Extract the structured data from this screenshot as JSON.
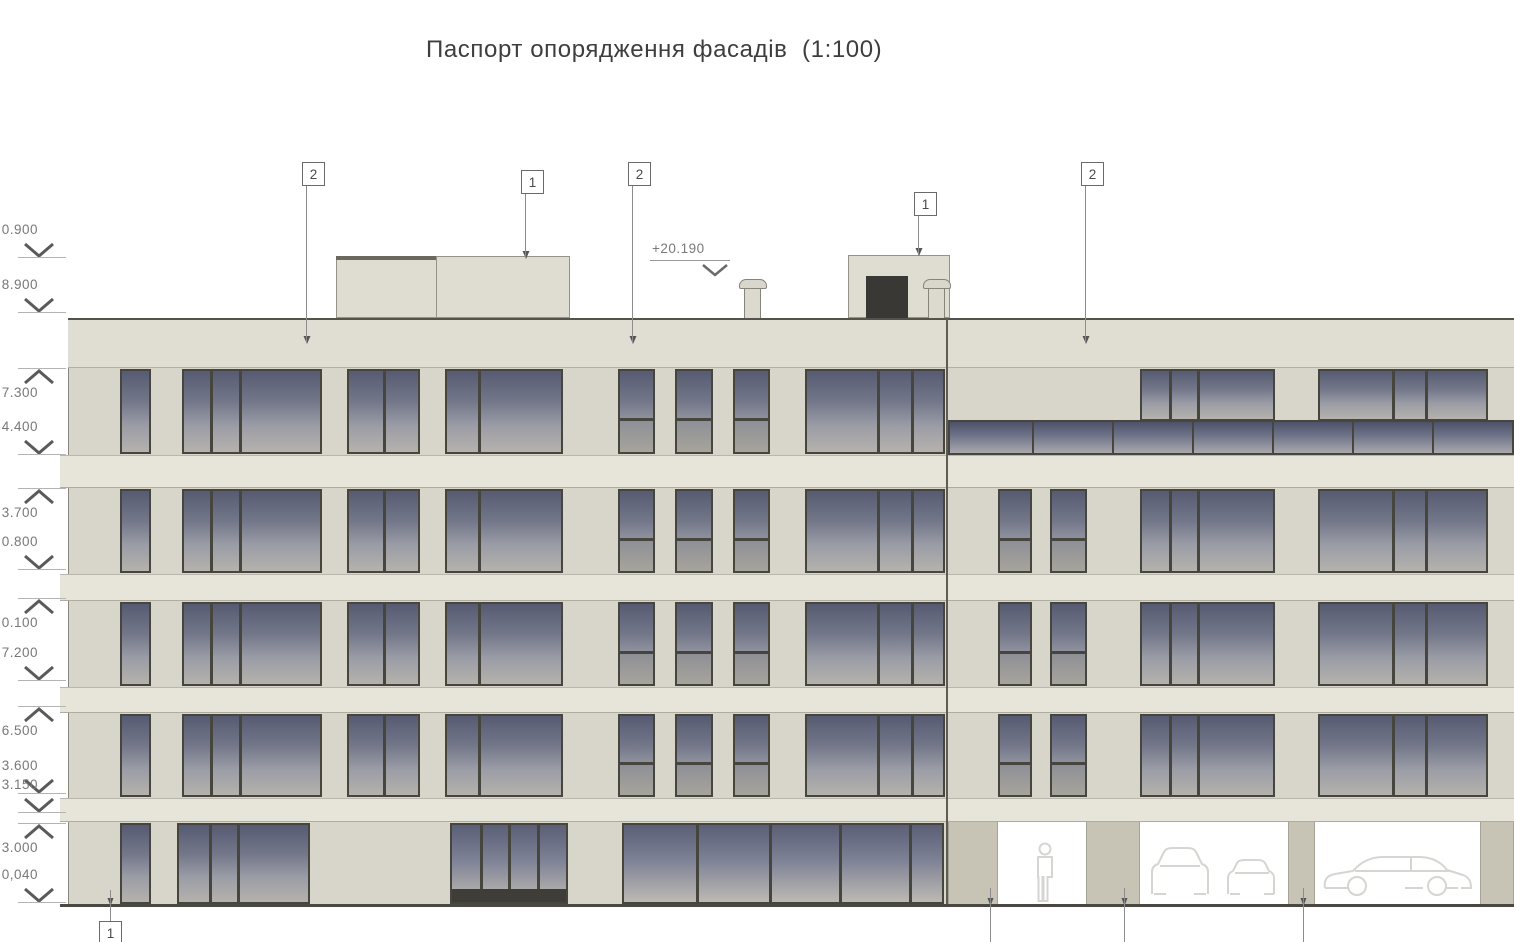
{
  "title": "Паспорт опорядження фасадів  (1:100)",
  "drawing": {
    "roof_annotation": {
      "text": "+20.190",
      "x": 652,
      "y": 241,
      "underline_x2": 730,
      "chevron_x": 700,
      "chevron_y": 262
    },
    "callouts": [
      {
        "label": "2",
        "x": 302,
        "y": 162,
        "drop": 343
      },
      {
        "label": "1",
        "x": 521,
        "y": 170,
        "drop": 258
      },
      {
        "label": "2",
        "x": 628,
        "y": 162,
        "drop": 343
      },
      {
        "label": "1",
        "x": 914,
        "y": 192,
        "drop": 255
      },
      {
        "label": "2",
        "x": 1081,
        "y": 162,
        "drop": 343
      }
    ],
    "bottom_callout": {
      "label": "1",
      "x": 99,
      "y": 921,
      "line_x": 110
    },
    "bottom_leader_xs": [
      990,
      1124,
      1303
    ],
    "elevation_markers": [
      {
        "value": "0.900",
        "dir": "down",
        "y": 258
      },
      {
        "value": "8.900",
        "dir": "down",
        "y": 313
      },
      {
        "value": "7.300",
        "dir": "up",
        "y": 368
      },
      {
        "value": "4.400",
        "dir": "down",
        "y": 455
      },
      {
        "value": "3.700",
        "dir": "up",
        "y": 488
      },
      {
        "value": "0.800",
        "dir": "down",
        "y": 570
      },
      {
        "value": "0.100",
        "dir": "up",
        "y": 598
      },
      {
        "value": "7.200",
        "dir": "down",
        "y": 681
      },
      {
        "value": "6.500",
        "dir": "up",
        "y": 706
      },
      {
        "value": "3.600",
        "dir": "down",
        "y": 794
      },
      {
        "value": "3.150",
        "dir": "down",
        "y": 813
      },
      {
        "value": "3.000",
        "dir": "up",
        "y": 823
      },
      {
        "value": "0,040",
        "dir": "down",
        "y": 903
      }
    ],
    "building": {
      "left": 68,
      "right": 1514,
      "top": 318,
      "bottom": 905,
      "divider_x": 946
    },
    "parapet": {
      "y": 318,
      "h": 50
    },
    "spandrels": [
      {
        "y": 455,
        "h": 33
      },
      {
        "y": 574,
        "h": 27
      },
      {
        "y": 687,
        "h": 26
      },
      {
        "y": 798,
        "h": 24
      }
    ],
    "window_bands": [
      {
        "y": 368,
        "h": 87,
        "left": "typ",
        "right": "top5"
      },
      {
        "y": 488,
        "h": 86,
        "left": "typ",
        "right": "typ"
      },
      {
        "y": 601,
        "h": 86,
        "left": "typ",
        "right": "typ"
      },
      {
        "y": 713,
        "h": 85,
        "left": "typ",
        "right": "typ"
      },
      {
        "y": 822,
        "h": 83,
        "left": "ground",
        "right": "parking"
      }
    ],
    "modules": {
      "left_typ": [
        {
          "x": 120,
          "w": 31,
          "panes": [
            1
          ]
        },
        {
          "x": 182,
          "w": 140,
          "panes": [
            0.2,
            0.21,
            0.59
          ]
        },
        {
          "x": 347,
          "w": 73,
          "panes": [
            0.5,
            0.5
          ]
        },
        {
          "x": 445,
          "w": 118,
          "panes": [
            0.28,
            0.72
          ]
        },
        {
          "x": 618,
          "w": 37,
          "panes": [
            1
          ],
          "transom": 0.62
        },
        {
          "x": 675,
          "w": 38,
          "panes": [
            1
          ],
          "transom": 0.62
        },
        {
          "x": 733,
          "w": 37,
          "panes": [
            1
          ],
          "transom": 0.62
        },
        {
          "x": 805,
          "w": 140,
          "panes": [
            0.52,
            0.25,
            0.23
          ]
        }
      ],
      "right_typ": [
        {
          "x": 998,
          "w": 34,
          "panes": [
            1
          ],
          "transom": 0.62
        },
        {
          "x": 1050,
          "w": 37,
          "panes": [
            1
          ],
          "transom": 0.62
        },
        {
          "x": 1140,
          "w": 135,
          "panes": [
            0.21,
            0.22,
            0.57
          ]
        },
        {
          "x": 1318,
          "w": 170,
          "panes": [
            0.44,
            0.2,
            0.36
          ]
        }
      ],
      "right_top5": [
        {
          "x": 1140,
          "w": 135,
          "panes": [
            0.21,
            0.22,
            0.57
          ]
        },
        {
          "x": 1318,
          "w": 170,
          "panes": [
            0.44,
            0.2,
            0.36
          ]
        }
      ],
      "left_ground": [
        {
          "x": 120,
          "w": 31,
          "panes": [
            1
          ]
        },
        {
          "x": 177,
          "w": 133,
          "panes": [
            0.24,
            0.22,
            0.54
          ]
        },
        {
          "x": 450,
          "w": 118,
          "panes": [
            0.25,
            0.25,
            0.25,
            0.25
          ],
          "dark_base": 13,
          "glass": "store"
        },
        {
          "x": 622,
          "w": 322,
          "panes": [
            0.23,
            0.23,
            0.22,
            0.22,
            0.1
          ],
          "glass": "store"
        }
      ],
      "ribbon": {
        "x": 948,
        "w": 566,
        "y": 420,
        "h": 35,
        "mullions": [
          1032,
          1112,
          1192,
          1272,
          1352,
          1432
        ]
      },
      "top5_window_h": 52
    },
    "parking": {
      "columns": [
        {
          "x": 948,
          "w": 50
        },
        {
          "x": 1086,
          "w": 54
        },
        {
          "x": 1288,
          "w": 27
        },
        {
          "x": 1480,
          "w": 34
        }
      ],
      "openings": [
        {
          "x": 998,
          "w": 88,
          "figure": "person"
        },
        {
          "x": 1140,
          "w": 148,
          "figure": "cars-front"
        },
        {
          "x": 1315,
          "w": 165,
          "figure": "car-side"
        }
      ]
    },
    "roof": {
      "penthouse": {
        "x": 336,
        "y": 256,
        "w": 234,
        "h": 62,
        "divider": 100
      },
      "bulkhead": {
        "x": 848,
        "y": 255,
        "w": 102,
        "h": 63
      },
      "door": {
        "x": 866,
        "y": 276,
        "w": 42,
        "h": 42
      },
      "vents": [
        {
          "x": 739,
          "y": 279
        },
        {
          "x": 923,
          "y": 279
        }
      ]
    },
    "colors": {
      "wall": "#d8d5ca",
      "spandrel": "#e7e4da",
      "parapet": "#e0ddd3",
      "frame": "#46463f",
      "ground_col": "#c7c3b5",
      "line_dark": "#4a4842",
      "leader": "#8c8c8c",
      "marker_text": "#787878",
      "silhouette": "#d6d5d1",
      "roof_fill": "#dfdcd2",
      "roof_edge": "#95928a",
      "door_dark": "#3a3834"
    }
  }
}
